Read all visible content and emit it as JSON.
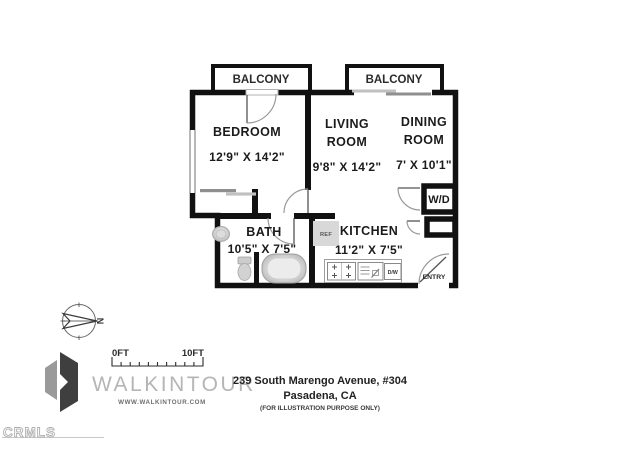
{
  "plan": {
    "balcony_left": "BALCONY",
    "balcony_right": "BALCONY",
    "bedroom_label": "BEDROOM",
    "bedroom_dims": "12'9\" X 14'2\"",
    "living_line1": "LIVING",
    "living_line2": "ROOM",
    "living_dims": "9'8\" X 14'2\"",
    "dining_line1": "DINING",
    "dining_line2": "ROOM",
    "dining_dims": "7' X 10'1\"",
    "bath_label": "BATH",
    "bath_dims": "10'5\" X 7'5\"",
    "kitchen_label": "KITCHEN",
    "kitchen_dims": "11'2\" X 7'5\"",
    "wd_label": "W/D",
    "entry_label": "ENTRY",
    "ref_label": "REF",
    "dw_label": "D/W",
    "compass_letter": "N"
  },
  "scale": {
    "start": "0FT",
    "end": "10FT"
  },
  "branding": {
    "name": "WALKINTOUR",
    "website": "WWW.WALKINTOUR.COM"
  },
  "address": {
    "line1": "239 South Marengo Avenue, #304",
    "line2": "Pasadena, CA",
    "disclaimer": "(FOR ILLUSTRATION PURPOSE ONLY)"
  },
  "watermark": "CRMLS",
  "colors": {
    "wall": "#111111",
    "refrigerator_fill": "#d8d8d8",
    "logo_text": "#b5b5b5",
    "logo_mark_dark": "#3f3f3f",
    "logo_mark_gray": "#9a9a9a"
  }
}
